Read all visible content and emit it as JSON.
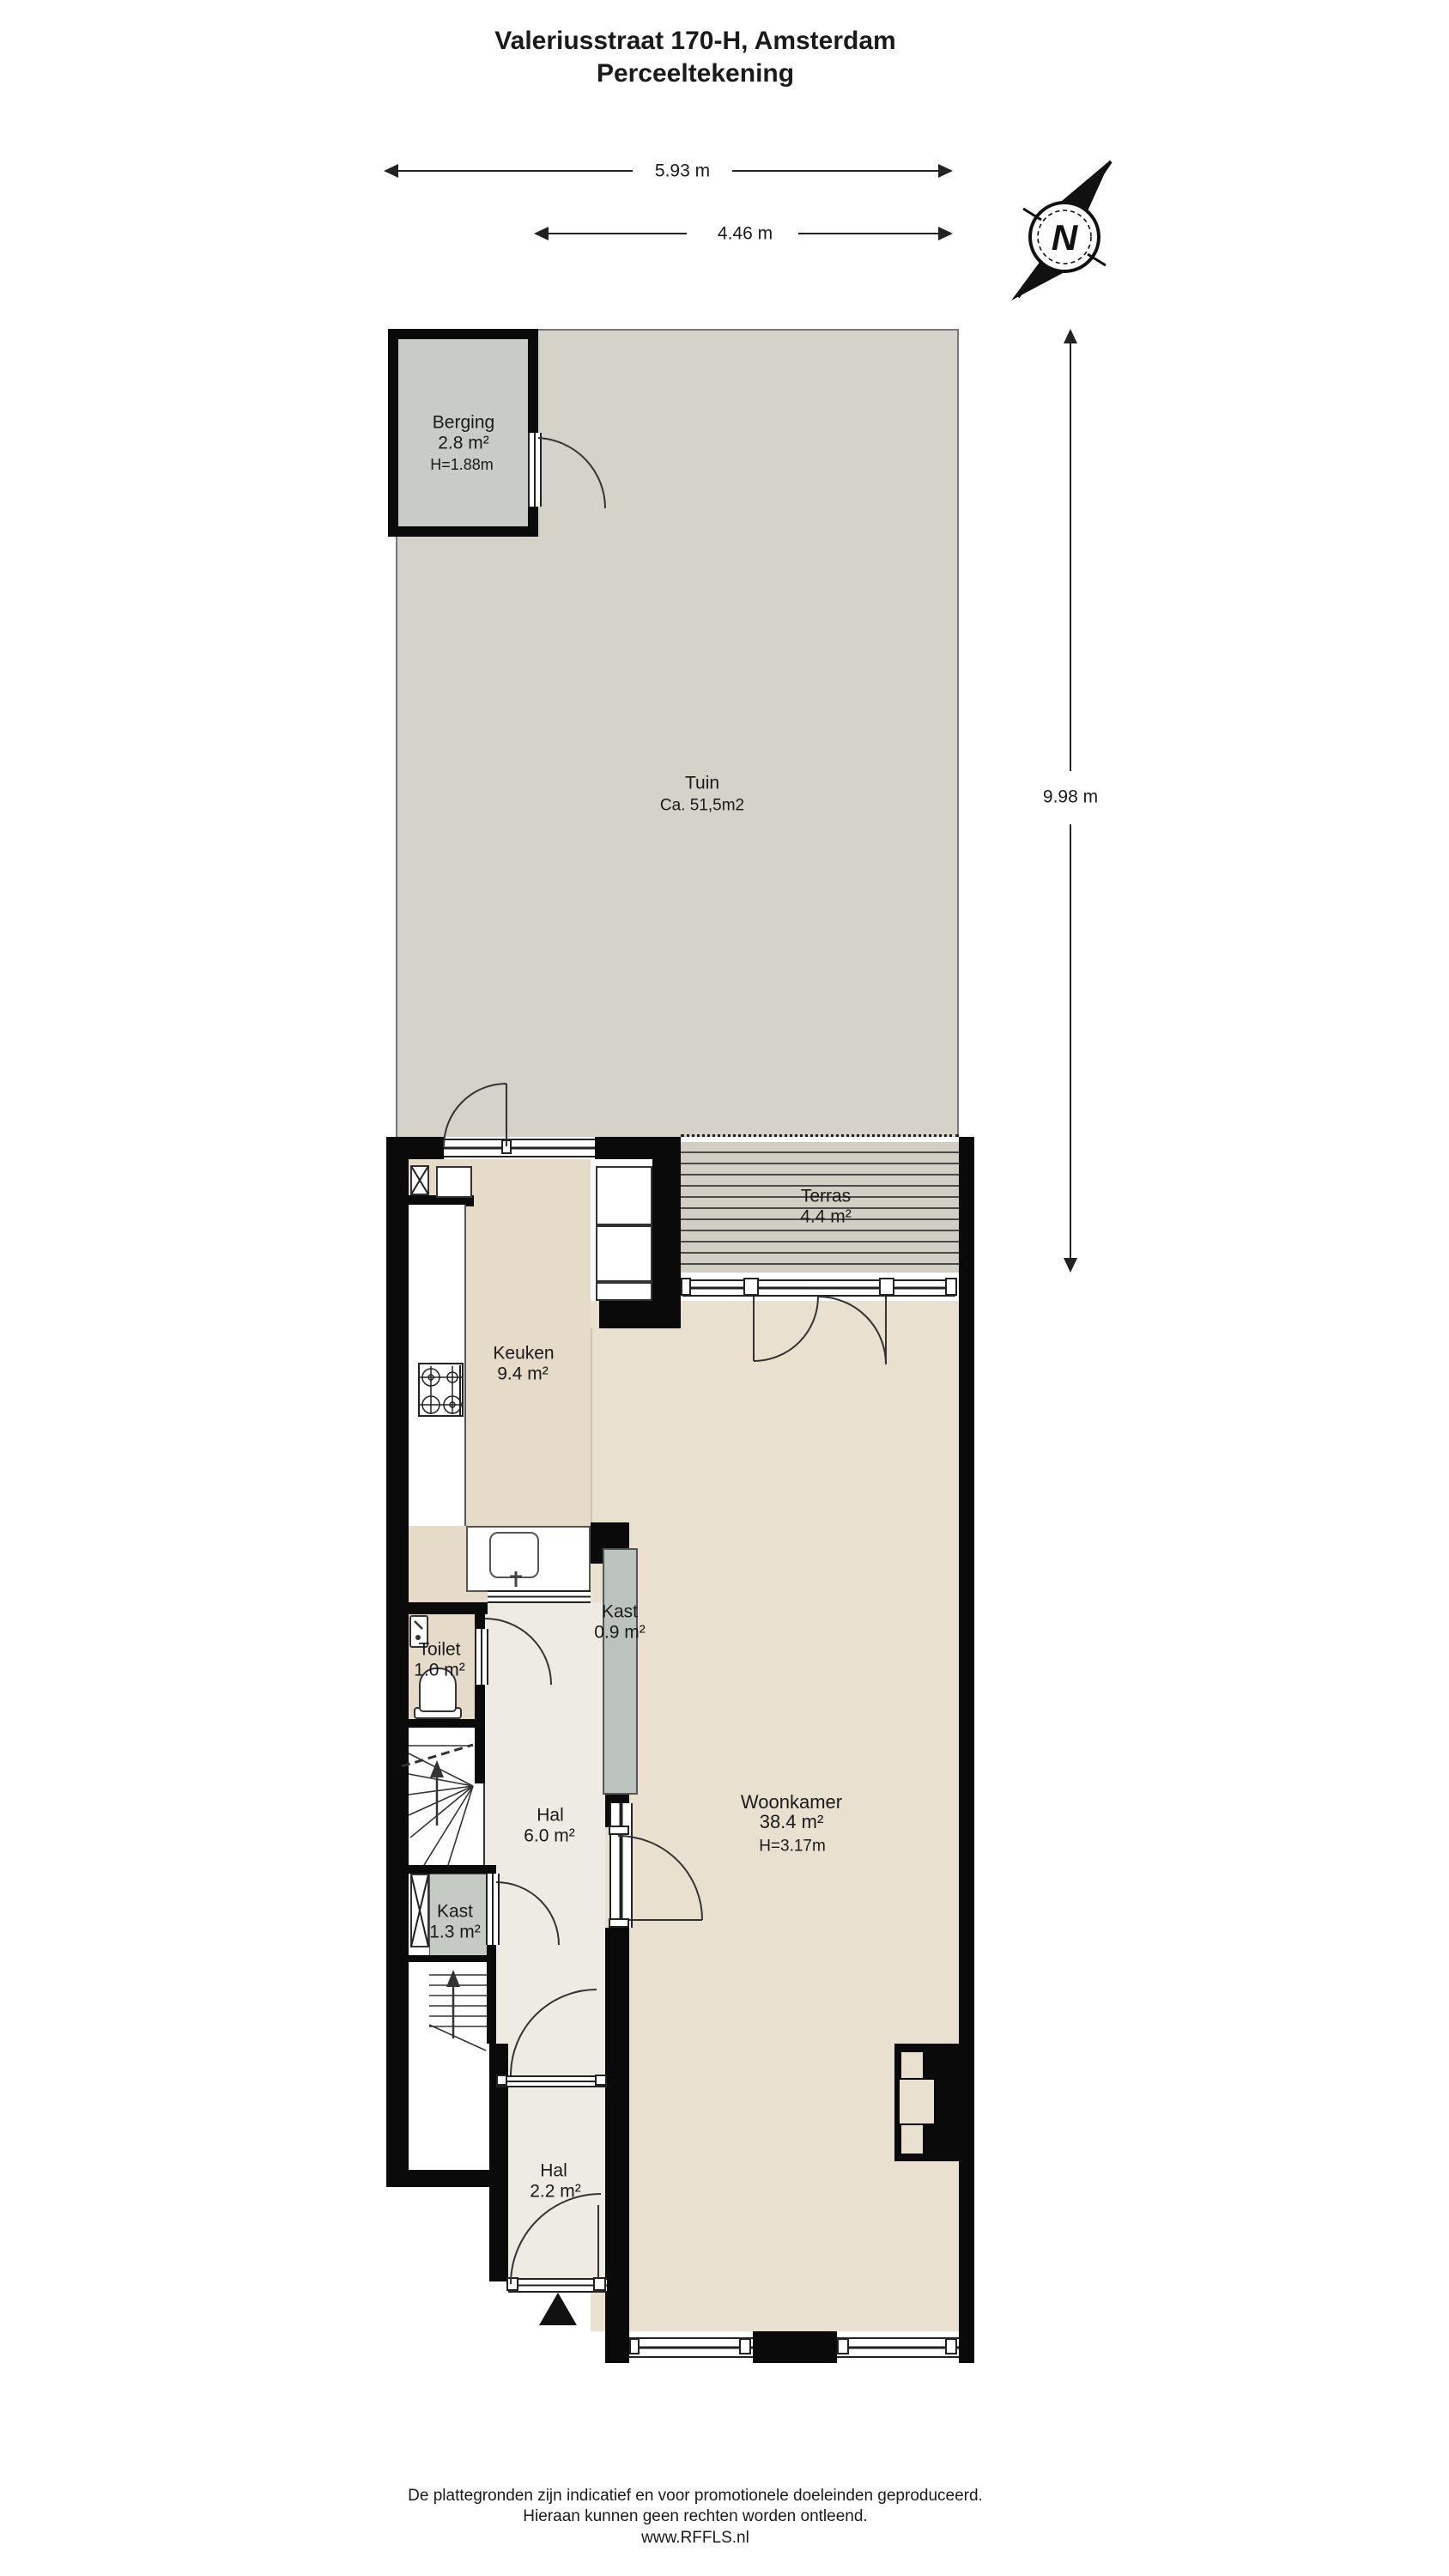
{
  "title": {
    "line1": "Valeriusstraat 170-H, Amsterdam",
    "line2": "Perceeltekening"
  },
  "dimensions": {
    "total_width": "5.93 m",
    "house_width": "4.46 m",
    "garden_depth": "9.98 m"
  },
  "compass": {
    "label": "N"
  },
  "rooms": {
    "berging": {
      "name": "Berging",
      "area": "2.8 m²",
      "height": "H=1.88m"
    },
    "tuin": {
      "name": "Tuin",
      "area": "Ca. 51,5m2"
    },
    "terras": {
      "name": "Terras",
      "area": "4.4 m²"
    },
    "keuken": {
      "name": "Keuken",
      "area": "9.4 m²"
    },
    "toilet": {
      "name": "Toilet",
      "area": "1.0 m²"
    },
    "kast_small": {
      "name": "Kast",
      "area": "0.9 m²"
    },
    "hal": {
      "name": "Hal",
      "area": "6.0 m²"
    },
    "kast_large": {
      "name": "Kast",
      "area": "1.3 m²"
    },
    "woonkamer": {
      "name": "Woonkamer",
      "area": "38.4 m²",
      "height": "H=3.17m"
    },
    "hal_entrance": {
      "name": "Hal",
      "area": "2.2 m²"
    }
  },
  "footer": {
    "line1": "De plattegronden zijn indicatief en voor promotionele doeleinden geproduceerd.",
    "line2": "Hieraan kunnen geen rechten worden ontleend.",
    "line3": "www.RFFLS.nl"
  },
  "colors": {
    "wall": "#0a0a0a",
    "garden": "#d5d2c9",
    "berging": "#c8ccc6",
    "deck": "#d1cfc4",
    "kitchen": "#e6dac9",
    "living": "#eae0d0",
    "hall": "#edebe4",
    "closet": "#c6cac5",
    "closet2": "#bcc2be",
    "line": "#222222"
  }
}
